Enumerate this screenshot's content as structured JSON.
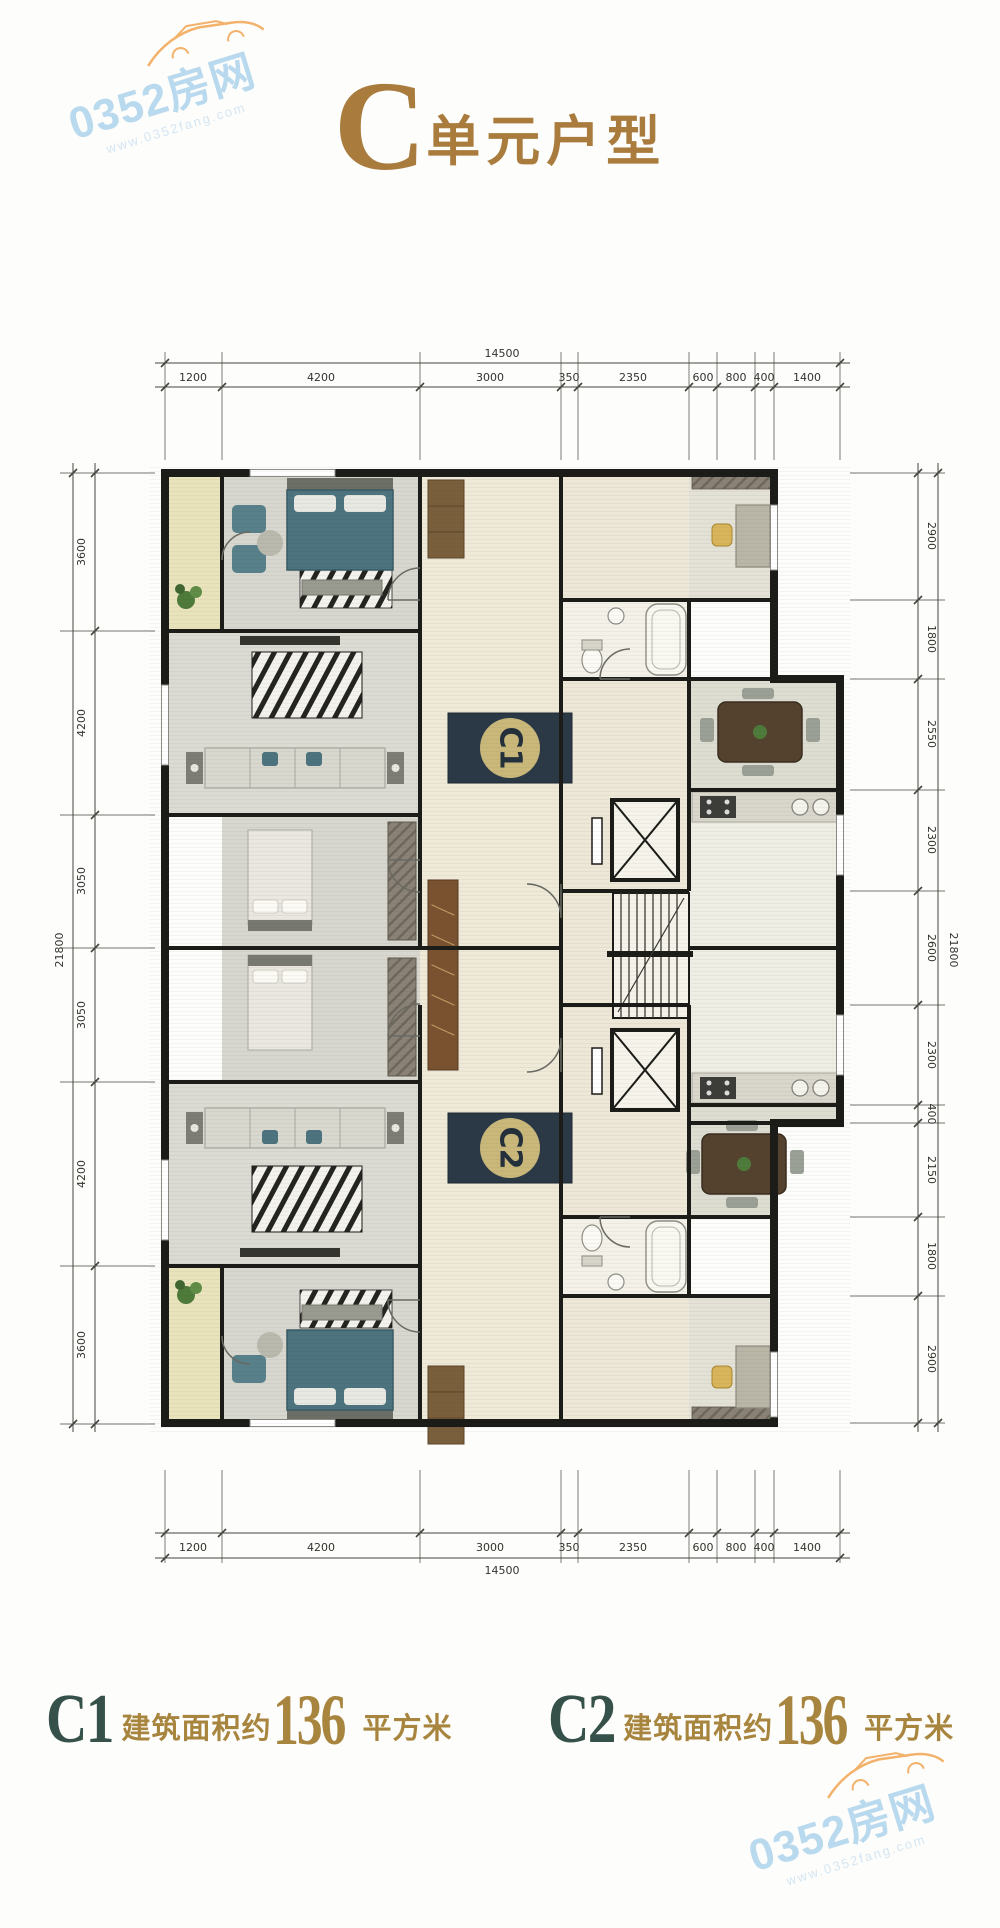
{
  "watermark": {
    "brand": "0352房网",
    "url": "www.0352fang.com"
  },
  "title": {
    "letter": "C",
    "text": "单元户型"
  },
  "plan": {
    "badges": [
      {
        "id": "C1"
      },
      {
        "id": "C2"
      }
    ],
    "dimensions": {
      "top": {
        "total": "14500",
        "segments": [
          "1200",
          "4200",
          "3000",
          "350",
          "2350",
          "600",
          "800",
          "400",
          "1400"
        ]
      },
      "bottom": {
        "total": "14500",
        "segments": [
          "1200",
          "4200",
          "3000",
          "350",
          "2350",
          "600",
          "800",
          "400",
          "1400"
        ]
      },
      "left": {
        "total": "21800",
        "segments": [
          "3600",
          "4200",
          "3050",
          "3050",
          "4200",
          "3600"
        ]
      },
      "right": {
        "total": "21800",
        "segments": [
          "2900",
          "1800",
          "2550",
          "2300",
          "2600",
          "2300",
          "400",
          "2150",
          "1800",
          "2900"
        ]
      }
    }
  },
  "footer": {
    "units": [
      {
        "name": "C1",
        "label": "建筑面积约",
        "area": "136",
        "suffix": "平方米"
      },
      {
        "name": "C2",
        "label": "建筑面积约",
        "area": "136",
        "suffix": "平方米"
      }
    ]
  },
  "colors": {
    "bronze": "#a97c3e",
    "gold": "#a8853e",
    "unitDark": "#35514a",
    "badgeNavy": "#2b3946",
    "badgeGold": "#c9b87a",
    "wmBlue": "#aed3ec",
    "wmBlueLight": "#cde2f2",
    "wmOrange": "#f2a552",
    "wall": "#1b1b18"
  }
}
